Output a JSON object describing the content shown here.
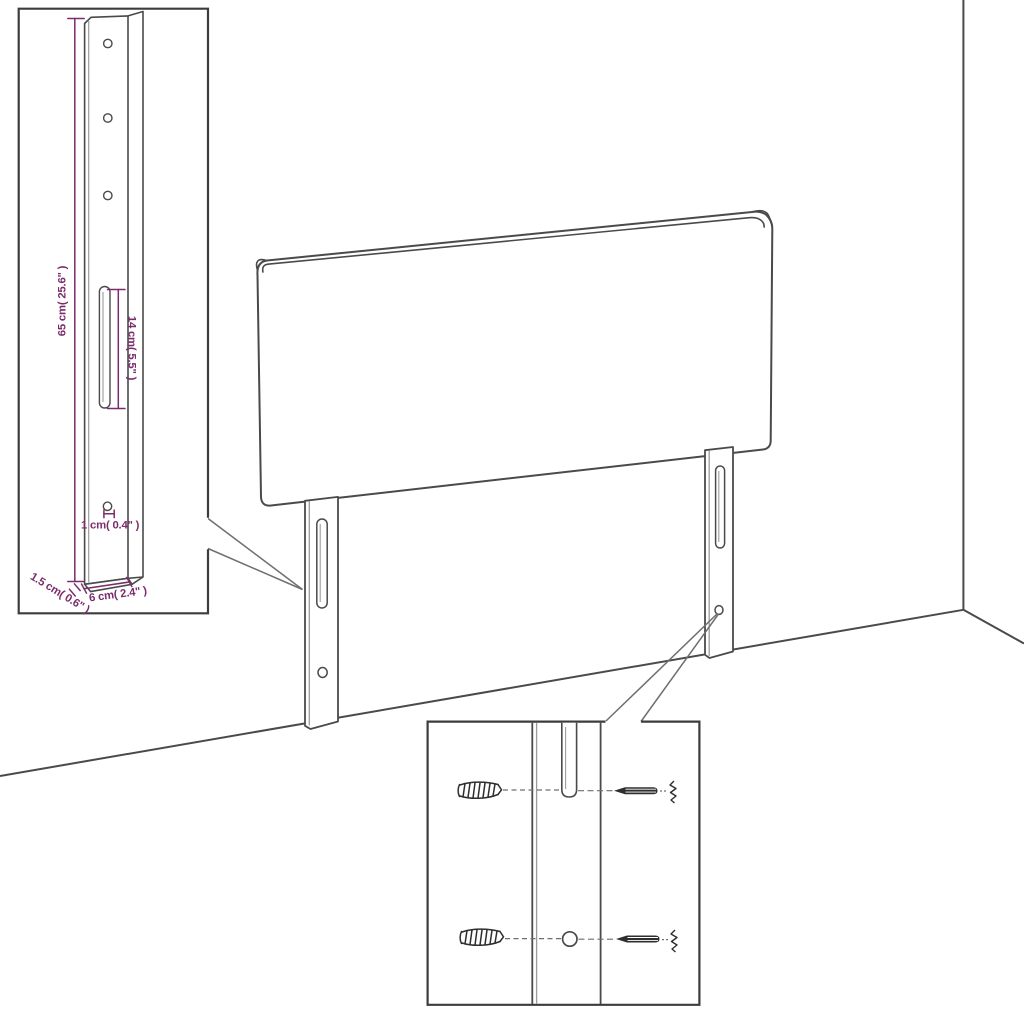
{
  "colors": {
    "background": "#ffffff",
    "outline": "#4a4a4a",
    "inset_border": "#3c3c3c",
    "highlight": "#9b9b9b",
    "dimension": "#7c2c6b",
    "hardware": "#2e2e2e"
  },
  "dimensions": {
    "leg_height": "65 cm( 25.6\" )",
    "slot_length": "14 cm( 5.5\" )",
    "hole_diameter": "1 cm( 0.4\" )",
    "leg_thickness": "1.5 cm( 0.6\" )",
    "leg_width": "6 cm( 2.4\" )"
  }
}
